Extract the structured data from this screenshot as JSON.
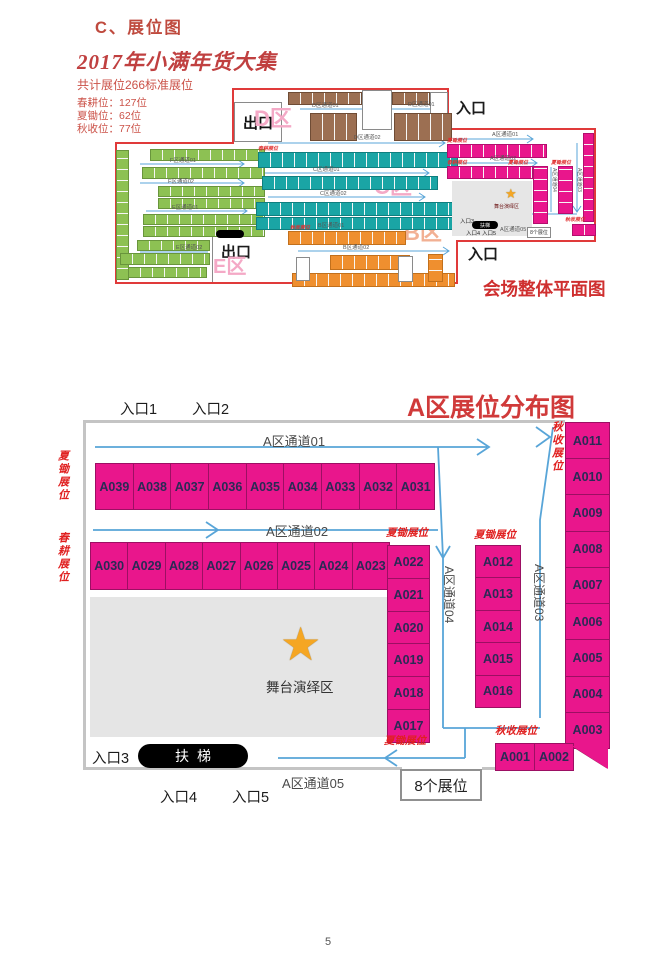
{
  "page": {
    "heading": "C、展位图",
    "page_number": "5"
  },
  "header": {
    "title": "2017年小满年货大集",
    "subtitle": "共计展位266标准展位",
    "stat1": "春耕位：127位",
    "stat2": "夏锄位：62位",
    "stat3": "秋收位：77位"
  },
  "overview": {
    "caption": "会场整体平面图",
    "exit_top": "出口",
    "exit_bottom": "出口",
    "entrance_top": "入口",
    "entrance_bottom": "入口",
    "zone_a": "A区",
    "zone_b": "B区",
    "zone_c": "C区",
    "zone_d": "D区",
    "zone_e": "E区",
    "ch_d1": "D区通道01",
    "ch_d1b": "D区通道01",
    "ch_d2": "D区通道02",
    "ch_c1": "C区通道01",
    "ch_c2": "C区通道02",
    "ch_b1": "B区通道01",
    "ch_b2": "B区通道02",
    "ch_f1": "F区通道01",
    "ch_f2": "F区通道02",
    "ch_e1": "E区通道01",
    "ch_e2": "E区通道02",
    "ch_a1": "A区通道01",
    "ch_a2": "A区通道02",
    "ch_a3": "A区通道03",
    "ch_a4": "A区通道04",
    "ch_a5": "A区通道05",
    "mini_stage": "舞台演绎区",
    "mini_escalator": "扶梯",
    "mini_entrance3": "入口3",
    "mini_entrance4": "入口4",
    "mini_entrance5": "入口5",
    "mini_booths8": "8个展位",
    "tiny_spring": "春耕展位",
    "tiny_summer": "夏锄展位",
    "tiny_autumn": "秋收展位"
  },
  "zone_a": {
    "title": "A区展位分布图",
    "entrance1": "入口1",
    "entrance2": "入口2",
    "entrance3": "入口3",
    "entrance4": "入口4",
    "entrance5": "入口5",
    "ch1": "A区通道01",
    "ch2": "A区通道02",
    "ch3": "A区通道03",
    "ch4": "A区通道04",
    "ch5": "A区通道05",
    "row1": [
      "A039",
      "A038",
      "A037",
      "A036",
      "A035",
      "A034",
      "A033",
      "A032",
      "A031"
    ],
    "row2": [
      "A030",
      "A029",
      "A028",
      "A027",
      "A026",
      "A025",
      "A024",
      "A023"
    ],
    "col_left": [
      "A022",
      "A021",
      "A020",
      "A019",
      "A018",
      "A017"
    ],
    "col_mid": [
      "A012",
      "A013",
      "A014",
      "A015",
      "A016"
    ],
    "col_right": [
      "A011",
      "A010",
      "A009",
      "A008",
      "A007",
      "A006",
      "A005",
      "A004",
      "A003"
    ],
    "bottom_row": [
      "A001",
      "A002"
    ],
    "stage_label": "舞台演绎区",
    "escalator": "扶梯",
    "eight_booths": "8个展位",
    "lbl_summer_left": "夏锄展位",
    "lbl_spring_left": "春耕展位",
    "lbl_autumn_right": "秋收展位",
    "lbl_summer_mid1": "夏锄展位",
    "lbl_summer_mid2": "夏锄展位",
    "lbl_summer_bottom": "夏锄展位",
    "lbl_autumn_bottom": "秋收展位"
  },
  "colors": {
    "booth_magenta": "#e9168c",
    "teal": "#1aa5a5",
    "orange": "#ef8f2f",
    "green": "#8dc153",
    "brown": "#9c6f52",
    "outline_red": "#e03a3a",
    "line_blue": "#58a5d8",
    "title_red": "#d03a3a",
    "label_red": "#e02020",
    "stage_gray": "#e5e5e5",
    "star_orange": "#f5a623"
  }
}
